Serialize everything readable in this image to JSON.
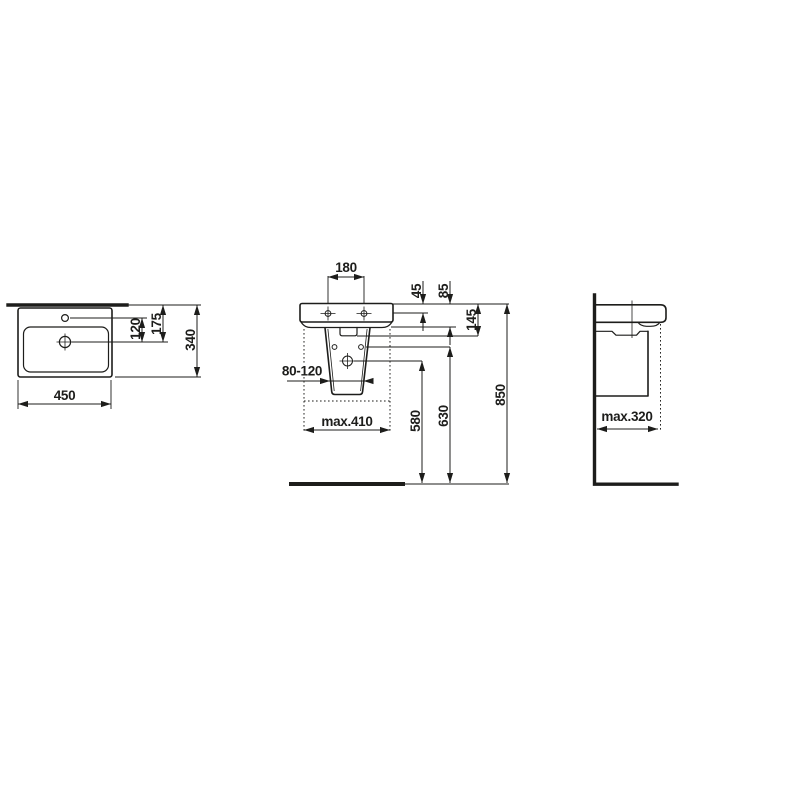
{
  "colors": {
    "ink": "#1d1d1b",
    "background": "#ffffff"
  },
  "views": {
    "top": {
      "width": "450",
      "tap_to_drain": "120",
      "edge_to_drain": "175",
      "depth": "340"
    },
    "front": {
      "hole_spacing": "180",
      "rim_to_hole": "45",
      "rim_to_apron": "85",
      "rim_to_overflow": "145",
      "trap_range": "80-120",
      "max_width": "max.410",
      "drain_height": "580",
      "fixing_height": "630",
      "rim_height": "850"
    },
    "side": {
      "max_depth": "max.320"
    }
  }
}
